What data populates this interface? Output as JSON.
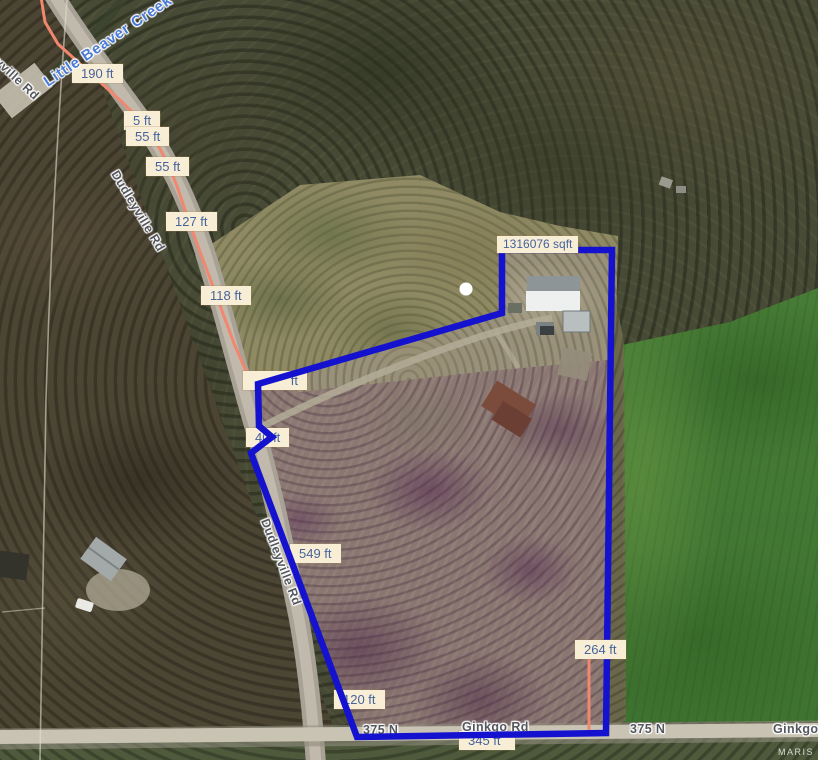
{
  "watermark": "MARIS",
  "area_chip": {
    "text": "1316076 sqft"
  },
  "roads": {
    "dudleyville_top": "Dudleyville Rd",
    "dudleyville_mid": "Dudleyville Rd",
    "dudleyville_low": "Dudleyville Rd",
    "creek": "Little Beaver Creek",
    "n375_west": "375 N",
    "n375_east": "375 N",
    "ginkgo_mid": "Ginkgo Rd",
    "ginkgo_right": "Ginkgo Rd"
  },
  "measurements": [
    {
      "text": "190 ft"
    },
    {
      "text": "5 ft"
    },
    {
      "text": "55 ft"
    },
    {
      "text": "55 ft"
    },
    {
      "text": "127 ft"
    },
    {
      "text": "118 ft"
    },
    {
      "text": "ft"
    },
    {
      "text": "40 ft"
    },
    {
      "text": "549 ft"
    },
    {
      "text": "120 ft"
    },
    {
      "text": "264 ft"
    },
    {
      "text": "345 ft"
    }
  ],
  "colors": {
    "parcel_outline": "#1512cf",
    "measure_line": "#f2876f",
    "chip_bg": "#f8eed6",
    "chip_text": "#46639b",
    "creek_text": "#4b7bd6",
    "road_label": "#54585e"
  }
}
